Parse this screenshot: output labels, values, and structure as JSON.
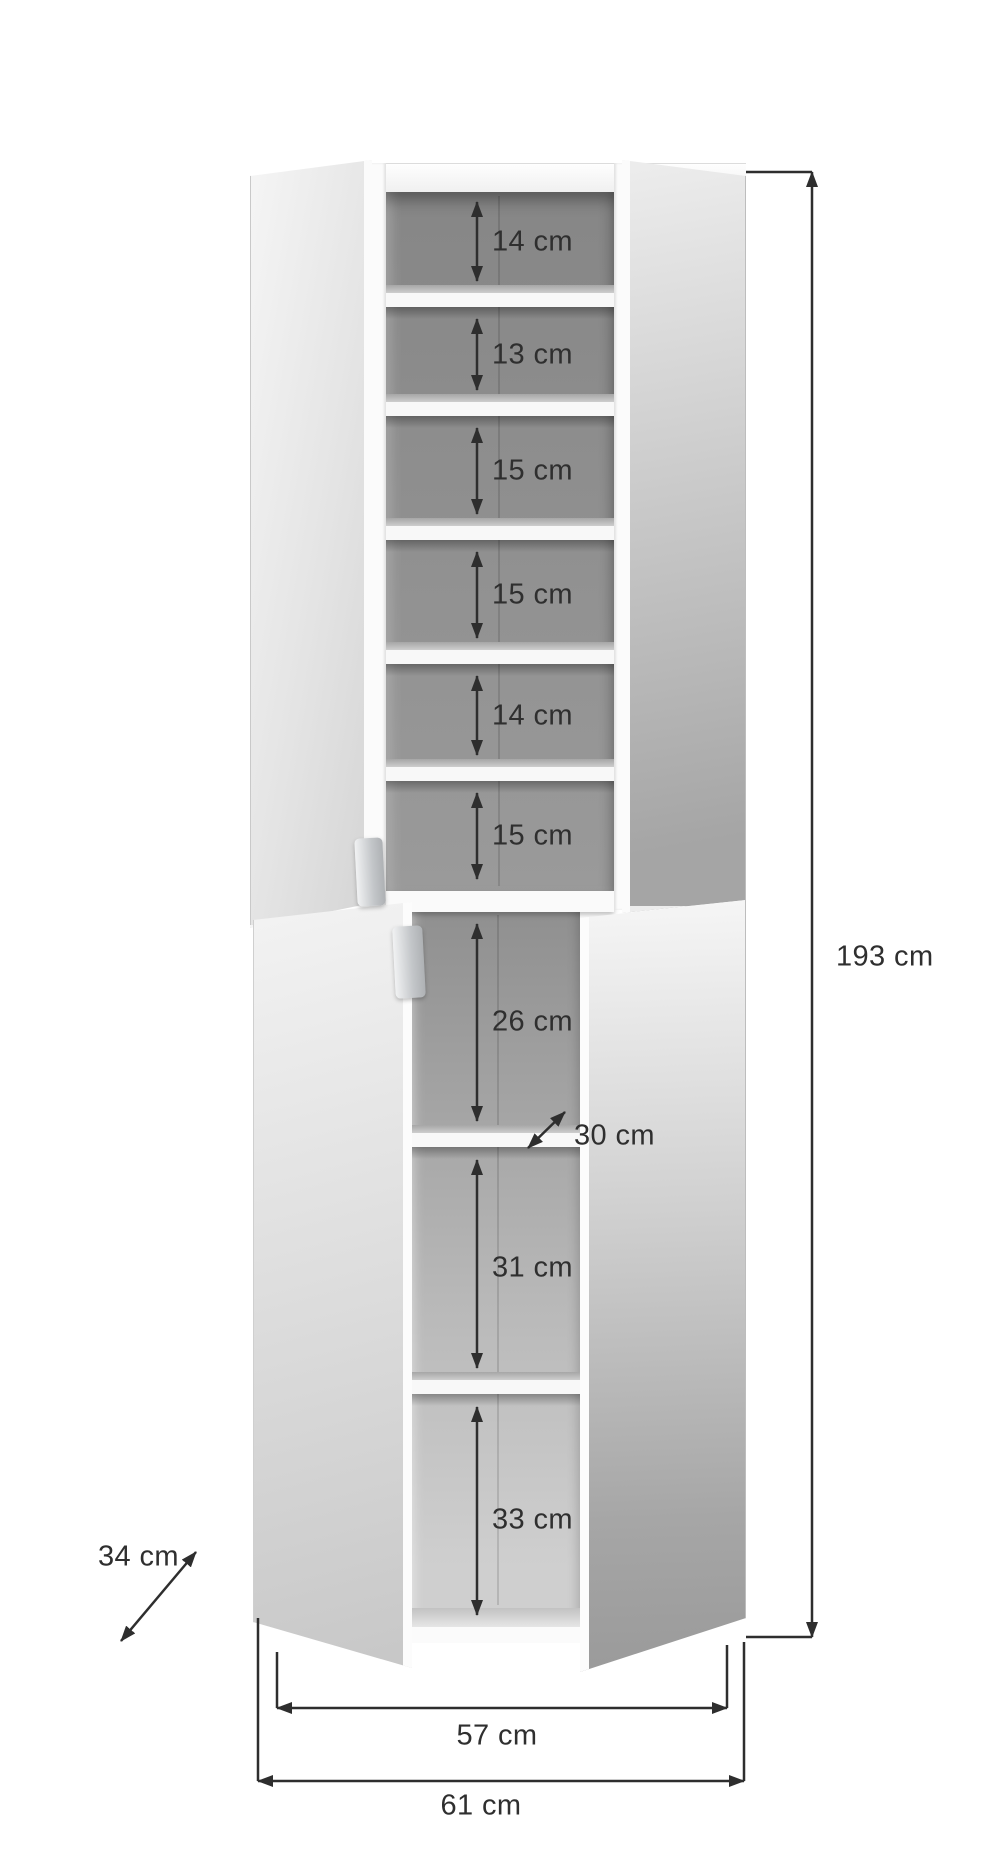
{
  "product": {
    "name": "Tall storage cabinet with open doors - dimension diagram",
    "unit": "cm"
  },
  "labels": {
    "height_total": "193 cm",
    "width_inner": "57 cm",
    "width_total": "61 cm",
    "depth_total": "34 cm",
    "depth_shelf": "30 cm",
    "top_shelves": [
      "14 cm",
      "13 cm",
      "15 cm",
      "15 cm",
      "14 cm",
      "15 cm"
    ],
    "bottom_shelves": [
      "26 cm",
      "31 cm",
      "33 cm"
    ]
  },
  "measurements_cm": {
    "total_height": 193,
    "inner_width": 57,
    "total_width": 61,
    "total_depth": 34,
    "shelf_depth": 30,
    "top_compartment_heights": [
      14,
      13,
      15,
      15,
      14,
      15
    ],
    "bottom_compartment_heights": [
      26,
      31,
      33
    ]
  },
  "colors": {
    "background": "#ffffff",
    "dimension_lines": "#2e2e2e",
    "label_text": "#2f2f2f",
    "interior_gray": "#8f8f8f",
    "shelf_white": "#f8f8f8",
    "door_light": "#ededed",
    "door_dark": "#9e9e9e",
    "handle_silver": "#c3c6c9"
  }
}
